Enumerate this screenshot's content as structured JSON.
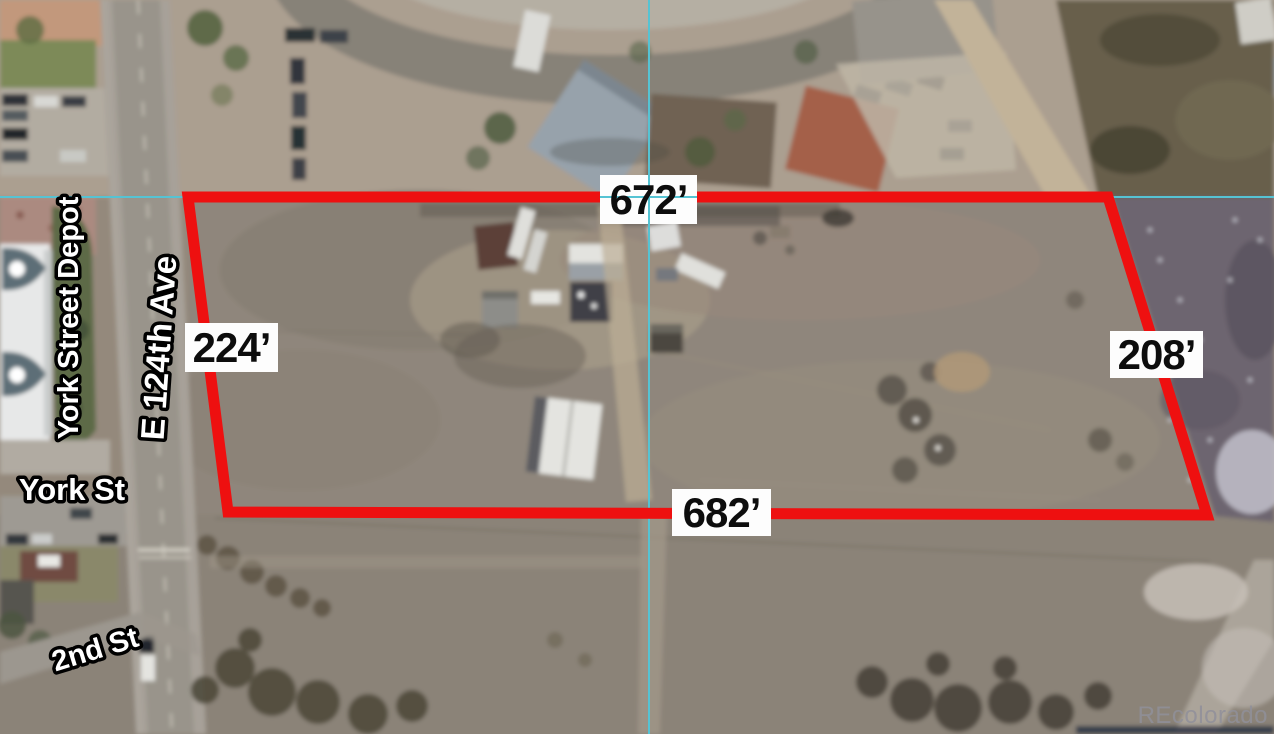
{
  "map": {
    "type": "aerial-parcel-view",
    "watermark": "REcolorado",
    "crosshair": {
      "color": "#55c3d3"
    },
    "parcel": {
      "outline_color": "#ee1010",
      "dimensions": {
        "top": "672’",
        "left": "224’",
        "right": "208’",
        "bottom": "682’"
      }
    },
    "street_labels": {
      "depot": "York Street Depot",
      "avenue": "E 124th Ave",
      "york": "York St",
      "second": "2nd St"
    }
  }
}
